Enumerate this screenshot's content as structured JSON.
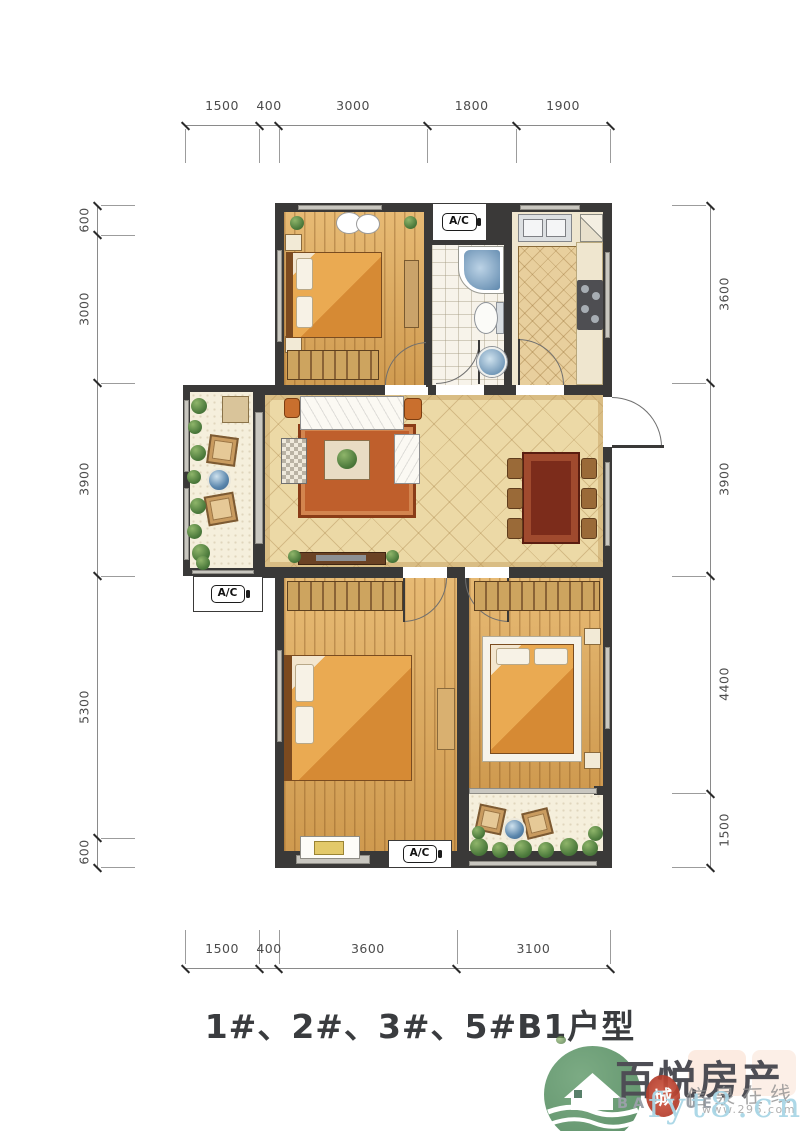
{
  "title": {
    "text": "1#、2#、3#、5#B1户型"
  },
  "plan": {
    "ac_label": "A/C"
  },
  "dimensions": {
    "top": {
      "values": [
        "1500",
        "400",
        "3000",
        "1800",
        "1900"
      ]
    },
    "bottom": {
      "values": [
        "1500",
        "400",
        "3600",
        "3100"
      ]
    },
    "left": {
      "values": [
        "600",
        "3000",
        "3900",
        "5300",
        "600"
      ]
    },
    "right": {
      "values": [
        "3600",
        "3900",
        "4400",
        "1500"
      ]
    }
  },
  "watermark": {
    "brand_cn": "百悦房产",
    "brand_en": "BAI YUE",
    "site": "fyt8.cn",
    "portal_cn": "信泉在线",
    "url_small": "www.296.com",
    "seal_char": "城"
  },
  "colors": {
    "wall": "#3a3938",
    "wood_floor": "#d8a55c",
    "living_tile": "#ecd9a6",
    "logo_green": "#6d9c77",
    "seal_red": "#c24233",
    "watermark_cyan": "#a9d6e6"
  }
}
